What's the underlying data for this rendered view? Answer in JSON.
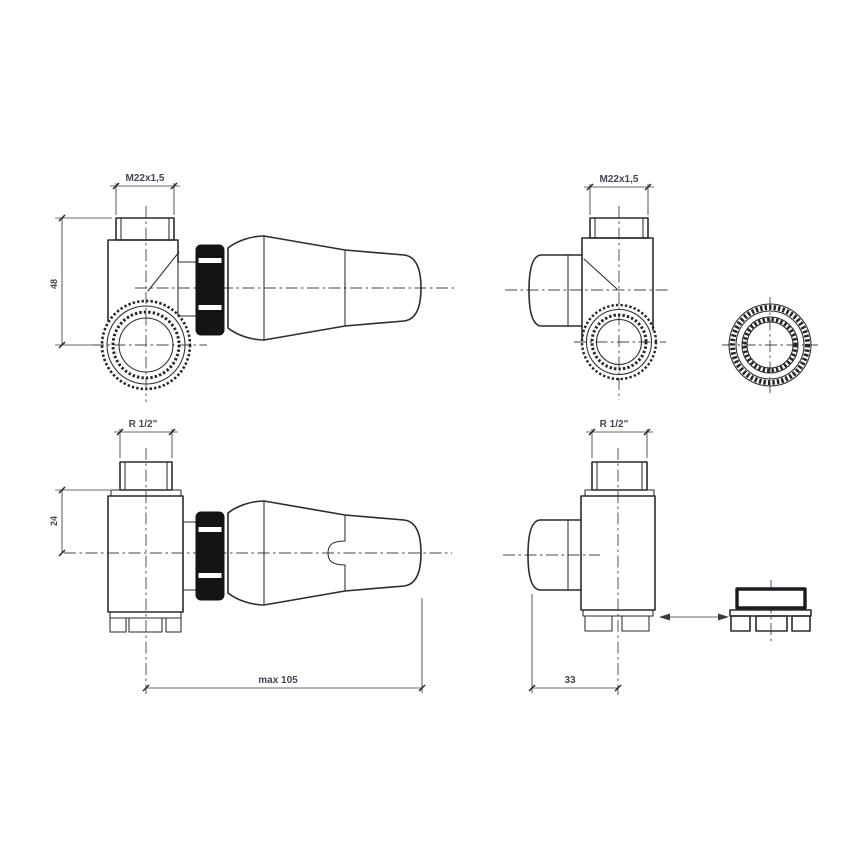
{
  "drawing": {
    "subject": "thermostatic-radiator-valve-orthographic-views",
    "views": {
      "top_left": {
        "thread_label": "M22x1,5",
        "height_dim": "48"
      },
      "top_right": {
        "thread_label": "M22x1,5"
      },
      "bottom_left": {
        "thread_label": "R 1/2\"",
        "height_dim": "24",
        "length_dim": "max 105"
      },
      "bottom_right": {
        "thread_label": "R 1/2\"",
        "offset_dim": "33"
      }
    },
    "colors": {
      "outline": "#2b2b30",
      "centerline": "#45454d",
      "dimension": "#3a3a42",
      "text": "#464653",
      "gland_nut_fill": "#141417",
      "background": "#ffffff"
    }
  }
}
